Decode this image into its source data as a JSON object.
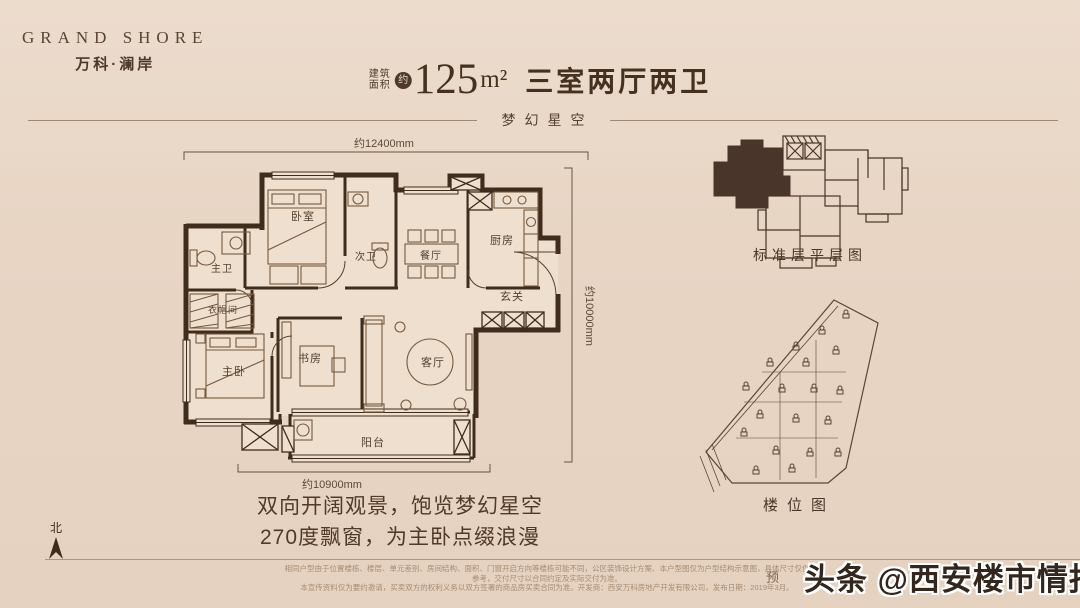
{
  "brand": {
    "logo_en": "GRAND SHORE",
    "logo_cn": "万科·澜岸"
  },
  "title": {
    "prefix_top": "建筑",
    "prefix_bottom": "面积",
    "approx_badge": "约",
    "area_number": "125",
    "area_unit": "m²",
    "layout_text": "三室两厅两卫",
    "subtitle": "梦幻星空"
  },
  "floorplan": {
    "dim_top": "约12400mm",
    "dim_right": "约10000mm",
    "dim_bottom": "约10900mm",
    "north_label": "北",
    "rooms": {
      "bedroom": "卧室",
      "second_bath": "次卫",
      "master_bath": "主卫",
      "cloakroom": "衣帽间",
      "master_bedroom": "主卧",
      "study": "书房",
      "living": "客厅",
      "dining": "餐厅",
      "kitchen": "厨房",
      "foyer": "玄关",
      "balcony": "阳台"
    }
  },
  "panels": {
    "floor_plate_caption": "标准层平层图",
    "site_plan_caption": "楼位图"
  },
  "tagline": {
    "line1": "双向开阔观景，饱览梦幻星空",
    "line2": "270度飘窗，为主卧点缀浪漫"
  },
  "disclaimer": {
    "line1": "相同户型由于位置楼栋、楼层、单元差别、房间结构、面积、门窗开启方向等楼栋可能不同，公区装饰设计方案、本户型图仅为户型结构示意图，具体尺寸仅供参考，交付尺寸以合同约定及实际交付为准。",
    "line2": "本宣传资料仅为要约邀请，买卖双方的权利义务以双方签署的商品房买卖合同为准。开发商：西安万科房地产开发有限公司，发布日期：2019年3月。",
    "partial": "预"
  },
  "watermark": {
    "source": "头条 ",
    "handle": "@西安楼市情报"
  },
  "colors": {
    "background": "#e8d5c4",
    "wall": "#3f2c1d",
    "ink": "#46311f",
    "highlight_unit": "#49352a"
  }
}
